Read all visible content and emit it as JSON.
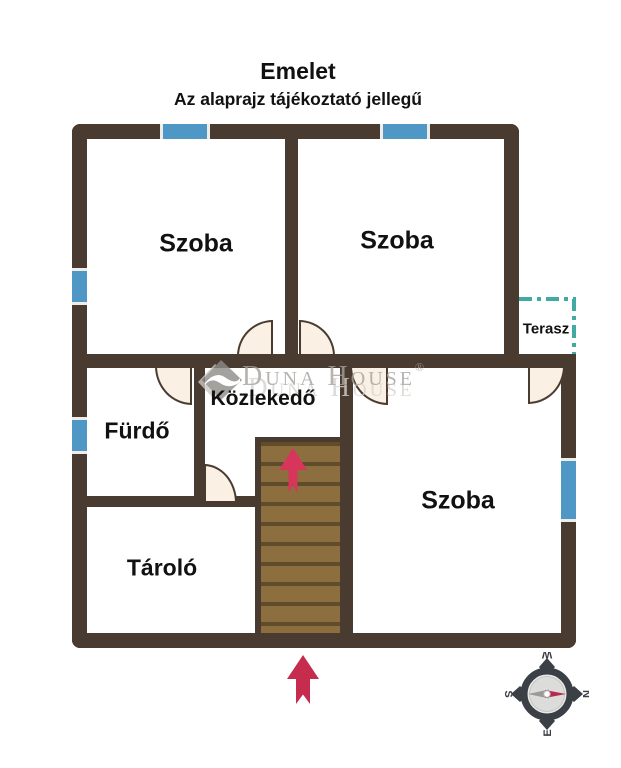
{
  "header": {
    "title": "Emelet",
    "subtitle": "Az alaprajz tájékoztató jellegű"
  },
  "rooms": {
    "szoba_top_left": "Szoba",
    "szoba_top_right": "Szoba",
    "szoba_bottom_right": "Szoba",
    "furdo": "Fürdő",
    "kozlekedo": "Közlekedő",
    "tarolo": "Tároló",
    "terasz": "Terasz"
  },
  "watermark": {
    "text": "Duna House",
    "registered": "®",
    "echo": "Duna House"
  },
  "compass": {
    "n": "N",
    "e": "E",
    "s": "S",
    "w": "W"
  },
  "colors": {
    "label": "#111111",
    "wall": "#4a3b31",
    "window_blue": "#4f98c5",
    "window_cap": "#f0ede8",
    "terrace_teal": "#43aaa3",
    "stair_fill": "#8d6e3e",
    "stair_line": "#5f4c2b",
    "door_fill": "#faf1e4",
    "arrow_red": "#c52c4e",
    "arrow_pink": "#d8355c",
    "compass_dark": "#3b3f46",
    "needle_red": "#b62b4d",
    "needle_gray": "#9a9a98",
    "wm_gray": "#a5a19d",
    "wm_light": "#d7d3cf"
  }
}
